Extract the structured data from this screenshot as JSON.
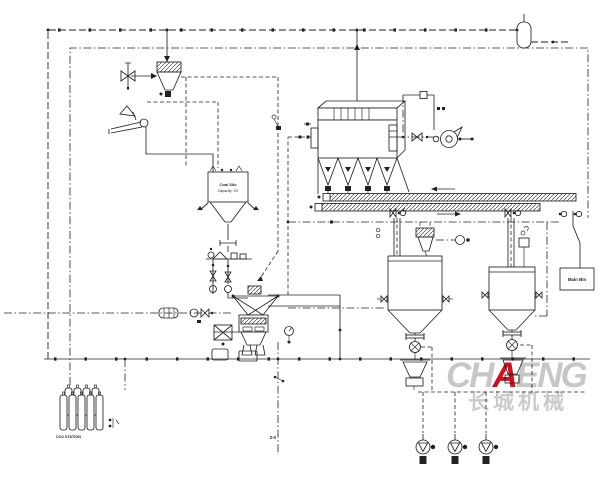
{
  "labels": {
    "coal_silo": {
      "line1": "Coal Silo",
      "line2": "Capacity: XX"
    },
    "main_bin": "Main Bin",
    "co2_station": "CO2 STATION",
    "drain_point": "Z-0"
  },
  "watermark": {
    "part1": "CH",
    "accent": "A",
    "part2": "ENG",
    "chinese": "长城机械"
  },
  "colors": {
    "line": "#222222",
    "background": "#ffffff",
    "watermark_gray": "#c7c7c7",
    "watermark_red": "#d2101e"
  }
}
